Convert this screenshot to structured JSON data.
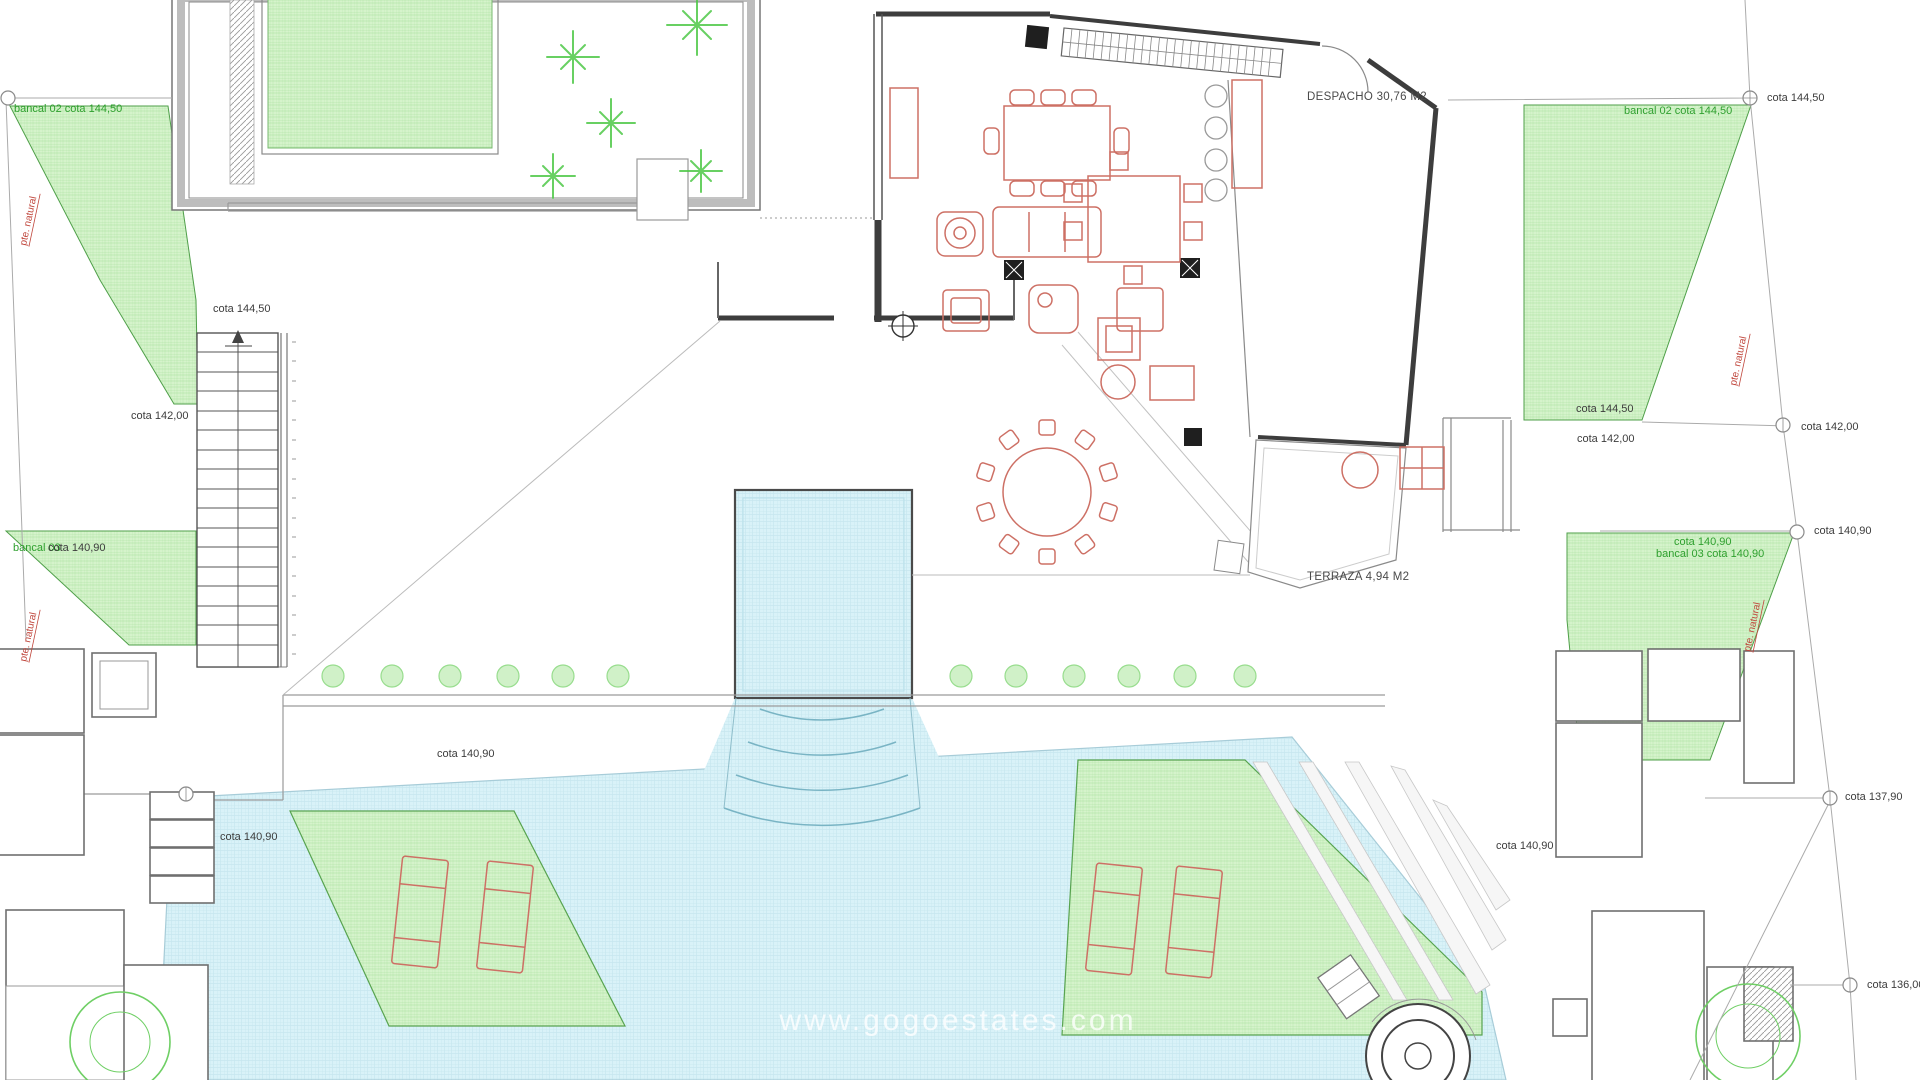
{
  "plan": {
    "watermark": "www.gogoestates.com",
    "rooms": {
      "despacho": "DESPACHO 30,76 M2",
      "terraza": "TERRAZA 4,94 M2"
    },
    "levels": {
      "cota_144_50": "cota 144,50",
      "cota_142_00": "cota 142,00",
      "cota_140_90": "cota 140,90",
      "cota_137_90": "cota 137,90",
      "cota_136_00": "cota 136,00"
    },
    "terraces": {
      "bancal02": "bancal 02 cota 144,50",
      "bancal03": "bancal 03",
      "bancal03_full": "bancal 03 cota 140,90",
      "slope": "pte. natural"
    },
    "colors": {
      "green_fill": "#d5f3cb",
      "green_edge": "#4f9f49",
      "label_green": "#2fa02f",
      "pool_fill": "#d9f2f8",
      "pool_edge": "#9fc9d6",
      "furniture_red": "#cd7065",
      "wall_dark": "#3d3d3d",
      "line_gray": "#8a8a8a",
      "slope_label_red": "#c0463c"
    }
  }
}
